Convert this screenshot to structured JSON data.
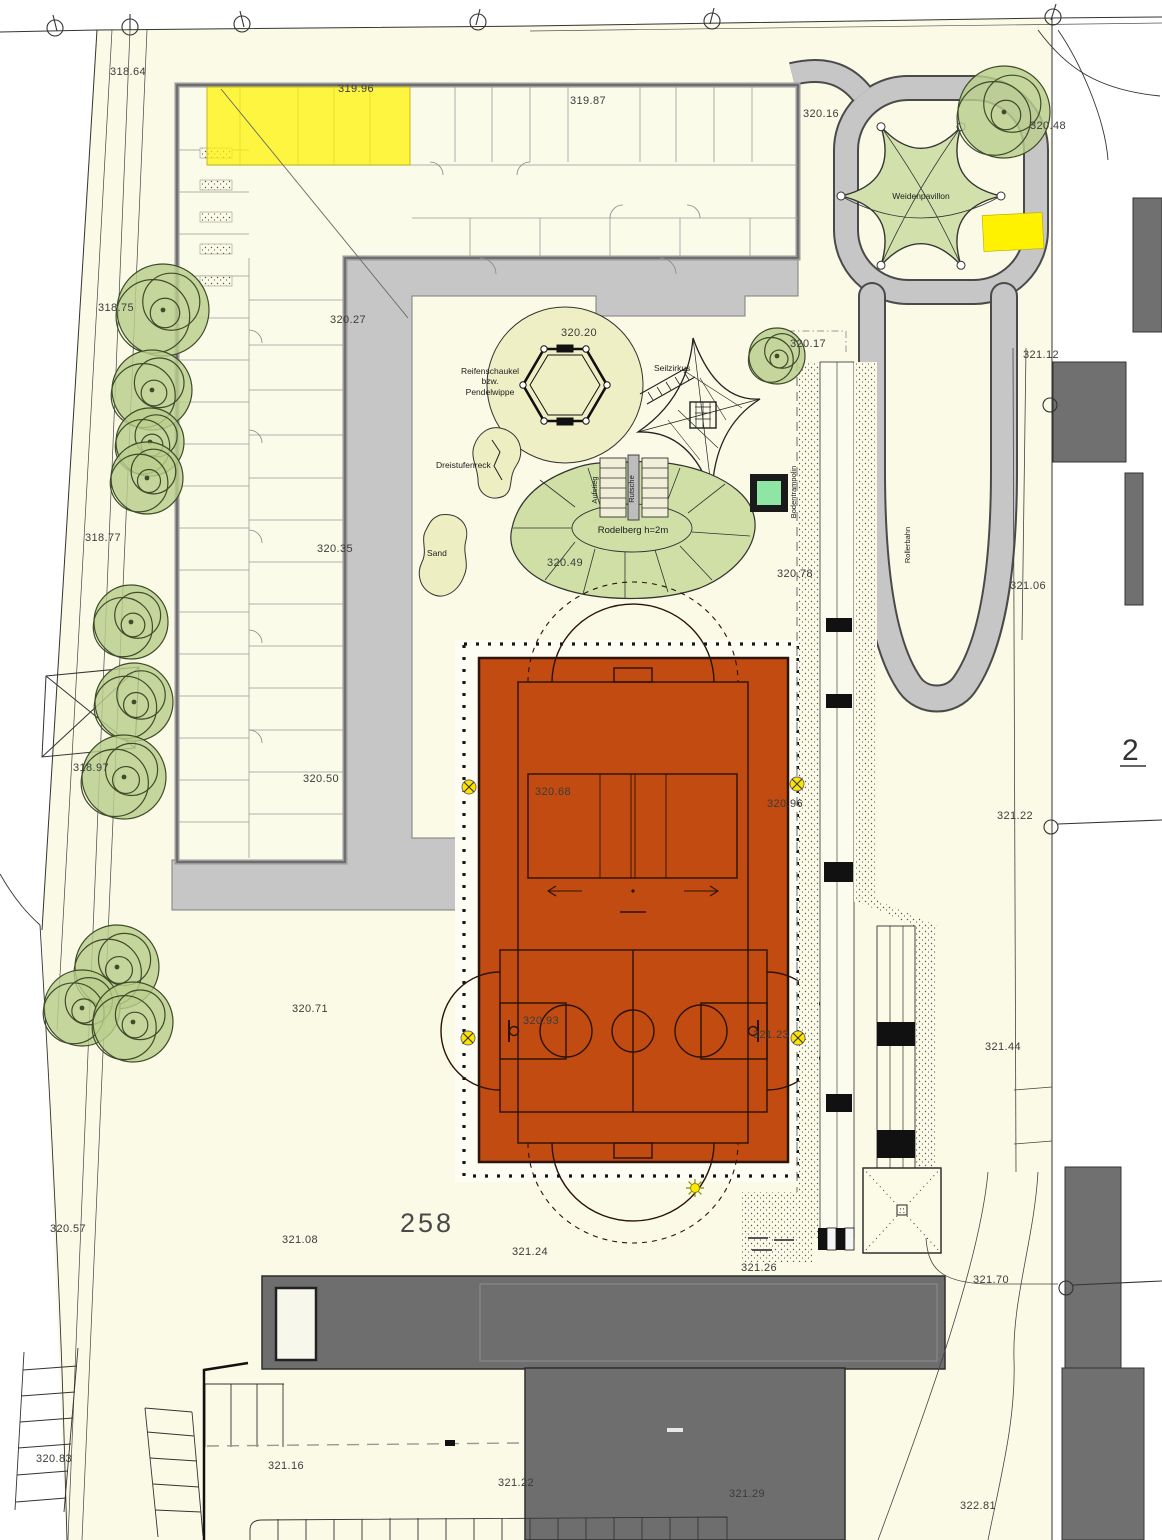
{
  "site": {
    "parcel_number_main": "258",
    "parcel_number_right": "2",
    "spot_elevations": [
      "318.64",
      "319.96",
      "319.87",
      "320.16",
      "320.48",
      "318.75",
      "320.27",
      "320.20",
      "320.17",
      "321.12",
      "318.77",
      "320.35",
      "320.49",
      "320.78",
      "321.06",
      "318.97",
      "320.50",
      "320.68",
      "320.96",
      "321.22",
      "320.71",
      "320.93",
      "321.23",
      "321.44",
      "320.57",
      "321.08",
      "321.24",
      "321.26",
      "321.70",
      "320.83",
      "321.16",
      "321.22",
      "321.29",
      "322.81"
    ]
  },
  "playground": {
    "weidenpavilion": "Weidenpavillon",
    "seilzirkus": "Seilzirkus",
    "reifenschaukel_line1": "Reifenschaukel",
    "reifenschaukel_line2": "bzw.",
    "reifenschaukel_line3": "Pendelwippe",
    "dreistufenreck": "Dreistufenreck",
    "sand": "Sand",
    "rodelberg": "Rodelberg h=2m",
    "aufstieg": "Aufstieg",
    "rutsche": "Rutsche",
    "bodentrampolin": "Bodentrampolin",
    "rollerbahn": "Rollerbahn"
  },
  "colors": {
    "site_fill": "#FAFAE6",
    "paving_gray": "#C6C6C6",
    "court_orange": "#C14B10",
    "highlight_yellow": "#FFF200",
    "green_area": "#CFDFA6",
    "tree_green": "#B9CE8C",
    "trampoline_green": "#8FE5A3",
    "dark_building": "#6E6E6E",
    "marker_yellow": "#FFE300"
  }
}
